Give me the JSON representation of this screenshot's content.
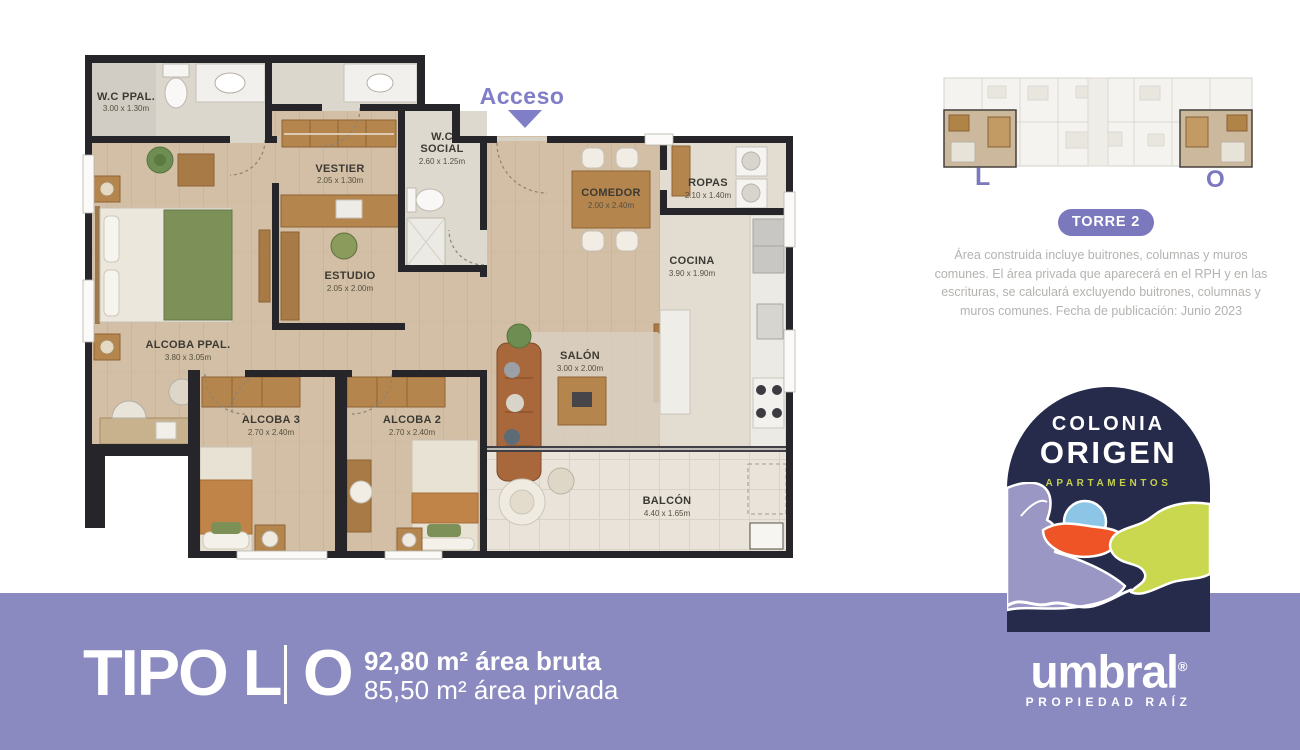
{
  "floorplan": {
    "access_label": "Acceso",
    "rooms": [
      {
        "name": "W.C PPAL.",
        "dims": "3.00 x 1.30m"
      },
      {
        "name": "VESTIER",
        "dims": "2.05 x 1.30m"
      },
      {
        "name_line1": "W.C",
        "name_line2": "SOCIAL",
        "dims": "2.60 x 1.25m"
      },
      {
        "name": "COMEDOR",
        "dims": "2.00 x 2.40m"
      },
      {
        "name": "ROPAS",
        "dims": "2.10 x 1.40m"
      },
      {
        "name": "COCINA",
        "dims": "3.90 x 1.90m"
      },
      {
        "name": "ESTUDIO",
        "dims": "2.05 x 2.00m"
      },
      {
        "name": "ALCOBA PPAL.",
        "dims": "3.80 x 3.05m"
      },
      {
        "name": "SALÓN",
        "dims": "3.00 x 2.00m"
      },
      {
        "name": "ALCOBA 3",
        "dims": "2.70 x 2.40m"
      },
      {
        "name": "ALCOBA 2",
        "dims": "2.70 x 2.40m"
      },
      {
        "name": "BALCÓN",
        "dims": "4.40 x 1.65m"
      }
    ]
  },
  "tower_panel": {
    "unit_left_label": "L",
    "unit_right_label": "O",
    "badge": "TORRE 2",
    "disclaimer": "Área construida incluye buitrones, columnas y muros comunes. El área privada que aparecerá en el RPH y en las escrituras, se calculará excluyendo buitrones, columnas y muros comunes.  Fecha de publicación: Junio 2023"
  },
  "brand": {
    "line1": "COLONIA",
    "line2": "ORIGEN",
    "line3": "APARTAMENTOS"
  },
  "developer": {
    "name": "umbral",
    "registered_mark": "®",
    "tagline": "PROPIEDAD RAÍZ"
  },
  "footer": {
    "type_label": "TIPO L",
    "unit_label": "O",
    "area_gross": "92,80 m² área bruta",
    "area_private": "85,50 m² área privada"
  },
  "colors": {
    "footer_purple": "#8a89c0",
    "badge_purple": "#7b78bd",
    "navy": "#262a4b",
    "logo_green": "#c9d84e",
    "logo_orange": "#ee5426",
    "logo_blue": "#8cc5e6",
    "logo_lavender": "#9a97c5"
  }
}
